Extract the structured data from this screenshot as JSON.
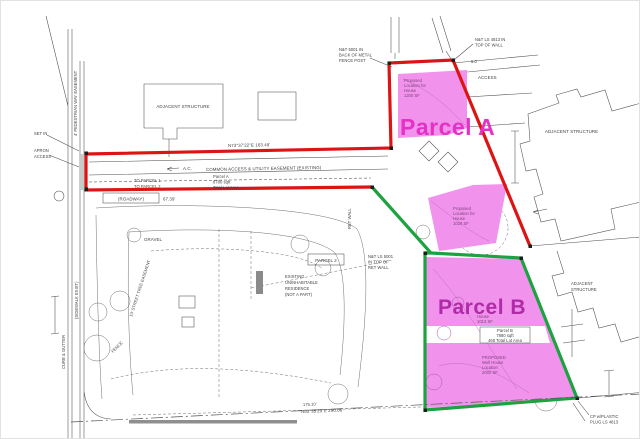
{
  "colors": {
    "parcel_a_outline": "#dd1414",
    "parcel_b_outline": "#1ca23e",
    "highlight_fill": "#f193ec",
    "parcel_a_title": "#e431c6",
    "parcel_b_title": "#b02ba8",
    "linework": "#4d4d4d"
  },
  "parcels": {
    "a": {
      "title": "Parcel A",
      "house_note": [
        "Proposed",
        "Location for",
        "House",
        "1200 SF"
      ],
      "area_note": [
        "Parcel A",
        "8780 sqft",
        "Total Lot Area"
      ]
    },
    "b": {
      "title": "Parcel B",
      "house_note": [
        "House",
        "1013 SF"
      ],
      "box_note": [
        "Parcel B",
        "7880 sqft",
        "468 Total Lot Area"
      ],
      "well_note": [
        "PROPOSED",
        "Well House",
        "Location",
        "2000 SF"
      ],
      "mid_house_note": [
        "Proposed",
        "Location for",
        "House",
        "1029 SF"
      ]
    }
  },
  "notes": {
    "common_access": "COMMON ACCESS & UTILITY EASEMENT (EXISTING)",
    "adjacent_structure": "ADJACENT STRUCTURE",
    "adjacent_structure_2l": [
      "ADJACENT",
      "STRUCTURE"
    ],
    "parcel2": "PARCEL 2",
    "residence": [
      "EXISTING",
      "UNINHABITABLE",
      "RESIDENCE",
      "(NOT A PART)"
    ],
    "fence_post_nail": [
      "N&T 5001 IN",
      "BACK OF METAL",
      "FENCE POST"
    ],
    "wall_nail": [
      "N&T LS 4813 IN",
      "TOP OF WALL"
    ],
    "ret_wall_nail": [
      "N&T LS 5001",
      "IN TOP OF",
      "RET WALL"
    ],
    "cp_plug": [
      "CP w/PLASTIC",
      "PLUG LS 4813"
    ],
    "roadway": "(ROADWAY)",
    "roadway_dim": "67.39'",
    "bearing_top": "N73°37'22\"E   163.49'",
    "bearing_bottom": "N53°35'29\"E   290.06'",
    "bottom_dim": "175.10'",
    "gravel": "GRAVEL",
    "ac": "A.C.",
    "access": "ACCESS",
    "access_dim": "5.0",
    "ret_wall": "RET WALL",
    "curb_gutter": "CURB & GUTTER",
    "sidewalk": "(SIDEWALK EXIST)",
    "street_tree": "10' STREET TREE EASEMENT",
    "fence": "FENCE",
    "apron": [
      "APRON",
      "ACCESS"
    ],
    "set_in": "SET IN",
    "pedestrian": "4' PEDESTRIAN WAY EASEMENT",
    "to_parcel": [
      "TO PARCEL 1",
      "TO PARCEL 2"
    ]
  }
}
